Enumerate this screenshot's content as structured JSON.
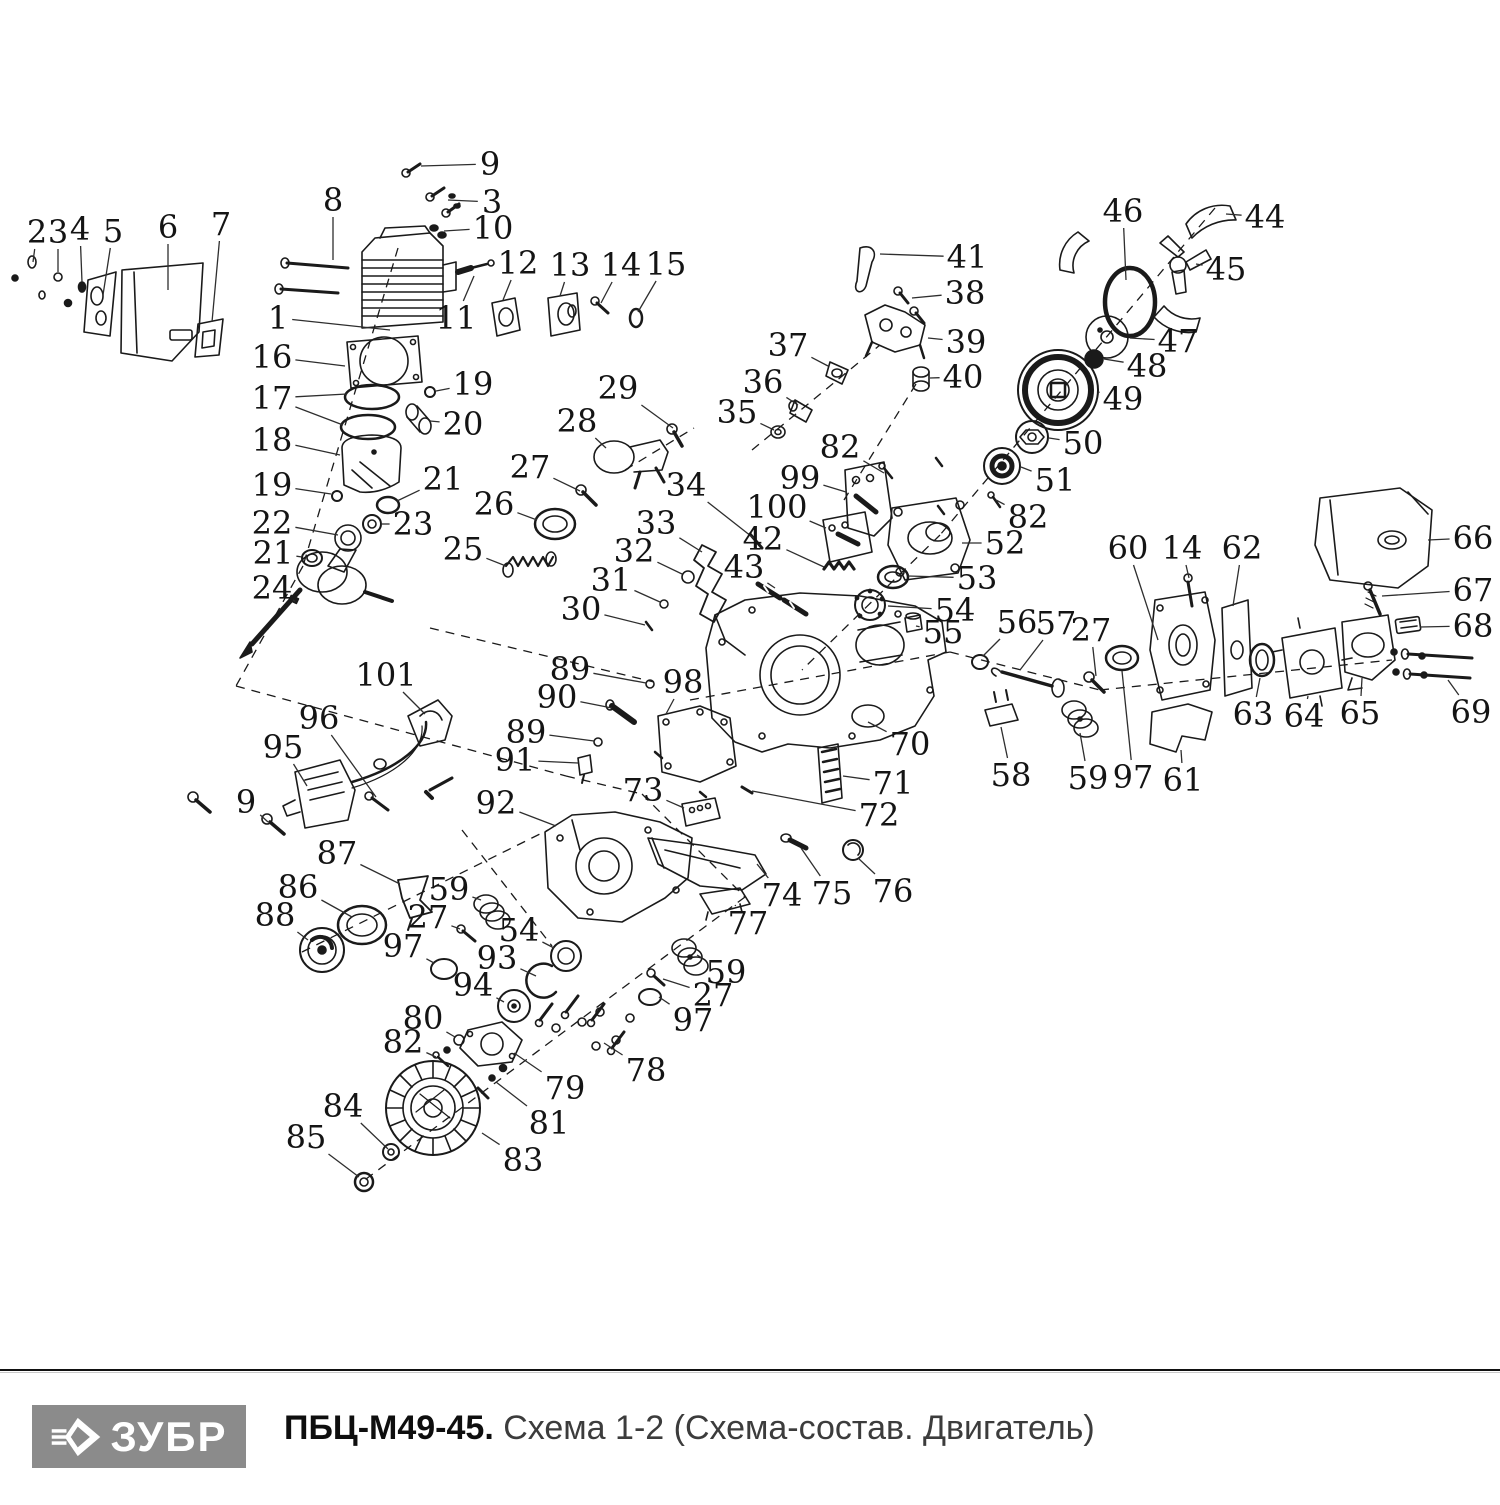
{
  "doc": {
    "type": "exploded-parts-diagram",
    "brand": "ЗУБР",
    "model": "ПБЦ-М49-45.",
    "subtitle": "Схема 1-2 (Схема-состав. Двигатель)",
    "logo_bg": "#8b8b8b",
    "line_color": "#1a1a1a",
    "label_color": "#141414"
  },
  "labels": [
    {
      "n": "2",
      "x": 37,
      "y": 232,
      "tx": 33,
      "ty": 262
    },
    {
      "n": "3",
      "x": 58,
      "y": 232,
      "tx": 58,
      "ty": 272
    },
    {
      "n": "4",
      "x": 80,
      "y": 229,
      "tx": 82,
      "ty": 282
    },
    {
      "n": "5",
      "x": 113,
      "y": 231,
      "tx": 103,
      "ty": 295
    },
    {
      "n": "6",
      "x": 168,
      "y": 227,
      "tx": 168,
      "ty": 290
    },
    {
      "n": "7",
      "x": 221,
      "y": 224,
      "tx": 212,
      "ty": 322
    },
    {
      "n": "8",
      "x": 333,
      "y": 200,
      "tx": 333,
      "ty": 260
    },
    {
      "n": "9",
      "x": 490,
      "y": 164,
      "tx": 421,
      "ty": 166
    },
    {
      "n": "3",
      "x": 492,
      "y": 202,
      "tx": 448,
      "ty": 200
    },
    {
      "n": "10",
      "x": 493,
      "y": 228,
      "tx": 444,
      "ty": 231
    },
    {
      "n": "1",
      "x": 278,
      "y": 318,
      "tx": 390,
      "ty": 330
    },
    {
      "n": "11",
      "x": 456,
      "y": 318,
      "tx": 474,
      "ty": 276
    },
    {
      "n": "12",
      "x": 518,
      "y": 263,
      "tx": 503,
      "ty": 300
    },
    {
      "n": "13",
      "x": 570,
      "y": 265,
      "tx": 560,
      "ty": 296
    },
    {
      "n": "14",
      "x": 621,
      "y": 265,
      "tx": 601,
      "ty": 303
    },
    {
      "n": "15",
      "x": 666,
      "y": 264,
      "tx": 638,
      "ty": 312
    },
    {
      "n": "16",
      "x": 272,
      "y": 357,
      "tx": 345,
      "ty": 366
    },
    {
      "n": "17",
      "x": 272,
      "y": 398,
      "tx": 347,
      "ty": 394,
      "tx2": 343,
      "ty2": 425
    },
    {
      "n": "18",
      "x": 272,
      "y": 440,
      "tx": 340,
      "ty": 455
    },
    {
      "n": "19",
      "x": 473,
      "y": 384,
      "tx": 436,
      "ty": 391
    },
    {
      "n": "20",
      "x": 463,
      "y": 424,
      "tx": 430,
      "ty": 421
    },
    {
      "n": "19",
      "x": 272,
      "y": 485,
      "tx": 331,
      "ty": 494
    },
    {
      "n": "21",
      "x": 443,
      "y": 479,
      "tx": 397,
      "ty": 501
    },
    {
      "n": "22",
      "x": 272,
      "y": 523,
      "tx": 338,
      "ty": 535
    },
    {
      "n": "23",
      "x": 413,
      "y": 524,
      "tx": 381,
      "ty": 524
    },
    {
      "n": "21",
      "x": 273,
      "y": 553,
      "tx": 302,
      "ty": 557
    },
    {
      "n": "24",
      "x": 272,
      "y": 588,
      "tx": 293,
      "ty": 600
    },
    {
      "n": "25",
      "x": 463,
      "y": 549,
      "tx": 506,
      "ty": 566
    },
    {
      "n": "26",
      "x": 494,
      "y": 504,
      "tx": 537,
      "ty": 520
    },
    {
      "n": "27",
      "x": 530,
      "y": 467,
      "tx": 580,
      "ty": 491
    },
    {
      "n": "28",
      "x": 577,
      "y": 421,
      "tx": 606,
      "ty": 448
    },
    {
      "n": "29",
      "x": 618,
      "y": 388,
      "tx": 673,
      "ty": 428
    },
    {
      "n": "30",
      "x": 581,
      "y": 609,
      "tx": 645,
      "ty": 625
    },
    {
      "n": "31",
      "x": 611,
      "y": 580,
      "tx": 660,
      "ty": 602
    },
    {
      "n": "32",
      "x": 634,
      "y": 551,
      "tx": 682,
      "ty": 574
    },
    {
      "n": "33",
      "x": 656,
      "y": 523,
      "tx": 702,
      "ty": 552
    },
    {
      "n": "34",
      "x": 686,
      "y": 485,
      "tx": 756,
      "ty": 540
    },
    {
      "n": "35",
      "x": 737,
      "y": 412,
      "tx": 774,
      "ty": 430
    },
    {
      "n": "36",
      "x": 763,
      "y": 382,
      "tx": 798,
      "ty": 405
    },
    {
      "n": "37",
      "x": 788,
      "y": 345,
      "tx": 828,
      "ty": 366
    },
    {
      "n": "38",
      "x": 965,
      "y": 293,
      "tx": 912,
      "ty": 298
    },
    {
      "n": "39",
      "x": 966,
      "y": 342,
      "tx": 928,
      "ty": 338
    },
    {
      "n": "40",
      "x": 963,
      "y": 377,
      "tx": 930,
      "ty": 378
    },
    {
      "n": "41",
      "x": 967,
      "y": 257,
      "tx": 880,
      "ty": 254
    },
    {
      "n": "42",
      "x": 763,
      "y": 539,
      "tx": 824,
      "ty": 567
    },
    {
      "n": "43",
      "x": 744,
      "y": 567,
      "tx": 775,
      "ty": 588
    },
    {
      "n": "44",
      "x": 1265,
      "y": 217,
      "tx": 1226,
      "ty": 214
    },
    {
      "n": "45",
      "x": 1226,
      "y": 269,
      "tx": 1196,
      "ty": 264
    },
    {
      "n": "46",
      "x": 1123,
      "y": 211,
      "tx": 1126,
      "ty": 280
    },
    {
      "n": "47",
      "x": 1178,
      "y": 341,
      "tx": 1130,
      "ty": 338
    },
    {
      "n": "48",
      "x": 1147,
      "y": 366,
      "tx": 1104,
      "ty": 359
    },
    {
      "n": "49",
      "x": 1123,
      "y": 399,
      "tx": 1098,
      "ty": 392
    },
    {
      "n": "50",
      "x": 1083,
      "y": 443,
      "tx": 1049,
      "ty": 438
    },
    {
      "n": "51",
      "x": 1055,
      "y": 480,
      "tx": 1021,
      "ty": 467
    },
    {
      "n": "82",
      "x": 840,
      "y": 447,
      "tx": 884,
      "ty": 473
    },
    {
      "n": "82",
      "x": 1028,
      "y": 517,
      "tx": 996,
      "ty": 500
    },
    {
      "n": "99",
      "x": 800,
      "y": 478,
      "tx": 846,
      "ty": 492
    },
    {
      "n": "100",
      "x": 777,
      "y": 507,
      "tx": 826,
      "ty": 528
    },
    {
      "n": "52",
      "x": 1005,
      "y": 543,
      "tx": 962,
      "ty": 543
    },
    {
      "n": "53",
      "x": 977,
      "y": 578,
      "tx": 908,
      "ty": 576
    },
    {
      "n": "54",
      "x": 955,
      "y": 610,
      "tx": 888,
      "ty": 606
    },
    {
      "n": "55",
      "x": 943,
      "y": 632,
      "tx": 916,
      "ty": 626
    },
    {
      "n": "56",
      "x": 1017,
      "y": 622,
      "tx": 983,
      "ty": 656
    },
    {
      "n": "57",
      "x": 1056,
      "y": 623,
      "tx": 1020,
      "ty": 670
    },
    {
      "n": "27",
      "x": 1091,
      "y": 630,
      "tx": 1096,
      "ty": 676
    },
    {
      "n": "58",
      "x": 1011,
      "y": 775,
      "tx": 1001,
      "ty": 727
    },
    {
      "n": "59",
      "x": 1088,
      "y": 778,
      "tx": 1080,
      "ty": 733
    },
    {
      "n": "97",
      "x": 1133,
      "y": 777,
      "tx": 1122,
      "ty": 671
    },
    {
      "n": "61",
      "x": 1183,
      "y": 780,
      "tx": 1181,
      "ty": 750
    },
    {
      "n": "60",
      "x": 1128,
      "y": 548,
      "tx": 1158,
      "ty": 640
    },
    {
      "n": "14",
      "x": 1182,
      "y": 548,
      "tx": 1189,
      "ty": 578
    },
    {
      "n": "62",
      "x": 1242,
      "y": 548,
      "tx": 1233,
      "ty": 606
    },
    {
      "n": "63",
      "x": 1253,
      "y": 714,
      "tx": 1260,
      "ty": 678
    },
    {
      "n": "64",
      "x": 1304,
      "y": 716,
      "tx": 1308,
      "ty": 696
    },
    {
      "n": "65",
      "x": 1360,
      "y": 713,
      "tx": 1362,
      "ty": 678
    },
    {
      "n": "66",
      "x": 1473,
      "y": 538,
      "tx": 1428,
      "ty": 540
    },
    {
      "n": "67",
      "x": 1473,
      "y": 590,
      "tx": 1382,
      "ty": 596
    },
    {
      "n": "68",
      "x": 1473,
      "y": 626,
      "tx": 1420,
      "ty": 627
    },
    {
      "n": "69",
      "x": 1471,
      "y": 712,
      "tx": 1448,
      "ty": 680
    },
    {
      "n": "70",
      "x": 910,
      "y": 744,
      "tx": 868,
      "ty": 722
    },
    {
      "n": "71",
      "x": 893,
      "y": 783,
      "tx": 843,
      "ty": 776
    },
    {
      "n": "72",
      "x": 879,
      "y": 815,
      "tx": 752,
      "ty": 791
    },
    {
      "n": "73",
      "x": 643,
      "y": 790,
      "tx": 684,
      "ty": 808
    },
    {
      "n": "74",
      "x": 782,
      "y": 895,
      "tx": 757,
      "ty": 864
    },
    {
      "n": "75",
      "x": 832,
      "y": 893,
      "tx": 801,
      "ty": 848
    },
    {
      "n": "76",
      "x": 893,
      "y": 891,
      "tx": 858,
      "ty": 858
    },
    {
      "n": "77",
      "x": 748,
      "y": 923,
      "tx": 735,
      "ty": 905
    },
    {
      "n": "59",
      "x": 726,
      "y": 972,
      "tx": 697,
      "ty": 955
    },
    {
      "n": "27",
      "x": 713,
      "y": 995,
      "tx": 663,
      "ty": 979
    },
    {
      "n": "97",
      "x": 693,
      "y": 1020,
      "tx": 659,
      "ty": 997
    },
    {
      "n": "89",
      "x": 570,
      "y": 669,
      "tx": 646,
      "ty": 683
    },
    {
      "n": "90",
      "x": 557,
      "y": 697,
      "tx": 612,
      "ty": 708
    },
    {
      "n": "89",
      "x": 526,
      "y": 732,
      "tx": 594,
      "ty": 741
    },
    {
      "n": "91",
      "x": 515,
      "y": 760,
      "tx": 578,
      "ty": 763
    },
    {
      "n": "92",
      "x": 496,
      "y": 803,
      "tx": 556,
      "ty": 826
    },
    {
      "n": "98",
      "x": 683,
      "y": 682,
      "tx": 666,
      "ty": 714
    },
    {
      "n": "101",
      "x": 386,
      "y": 675,
      "tx": 425,
      "ty": 714
    },
    {
      "n": "96",
      "x": 319,
      "y": 718,
      "tx": 376,
      "ty": 797
    },
    {
      "n": "95",
      "x": 283,
      "y": 747,
      "tx": 307,
      "ty": 786
    },
    {
      "n": "9",
      "x": 246,
      "y": 802,
      "tx": 268,
      "ty": 822
    },
    {
      "n": "87",
      "x": 337,
      "y": 853,
      "tx": 400,
      "ty": 884
    },
    {
      "n": "86",
      "x": 298,
      "y": 887,
      "tx": 352,
      "ty": 917
    },
    {
      "n": "88",
      "x": 275,
      "y": 915,
      "tx": 308,
      "ty": 940
    },
    {
      "n": "59",
      "x": 449,
      "y": 889,
      "tx": 481,
      "ty": 900
    },
    {
      "n": "27",
      "x": 428,
      "y": 917,
      "tx": 460,
      "ty": 929
    },
    {
      "n": "97",
      "x": 403,
      "y": 946,
      "tx": 434,
      "ty": 963
    },
    {
      "n": "54",
      "x": 519,
      "y": 930,
      "tx": 554,
      "ty": 948
    },
    {
      "n": "93",
      "x": 497,
      "y": 958,
      "tx": 536,
      "ty": 976
    },
    {
      "n": "94",
      "x": 473,
      "y": 985,
      "tx": 504,
      "ty": 1002
    },
    {
      "n": "80",
      "x": 423,
      "y": 1018,
      "tx": 455,
      "ty": 1037
    },
    {
      "n": "82",
      "x": 403,
      "y": 1042,
      "tx": 436,
      "ty": 1057
    },
    {
      "n": "79",
      "x": 565,
      "y": 1088,
      "tx": 514,
      "ty": 1053
    },
    {
      "n": "81",
      "x": 549,
      "y": 1123,
      "tx": 496,
      "ty": 1082
    },
    {
      "n": "78",
      "x": 646,
      "y": 1070,
      "tx": 604,
      "ty": 1043
    },
    {
      "n": "84",
      "x": 343,
      "y": 1106,
      "tx": 388,
      "ty": 1149
    },
    {
      "n": "85",
      "x": 306,
      "y": 1137,
      "tx": 359,
      "ty": 1177
    },
    {
      "n": "83",
      "x": 523,
      "y": 1160,
      "tx": 482,
      "ty": 1133
    }
  ],
  "axes": [
    [
      398,
      248,
      303,
      566
    ],
    [
      303,
      566,
      236,
      686
    ],
    [
      236,
      686,
      566,
      776
    ],
    [
      566,
      776,
      642,
      794
    ],
    [
      642,
      794,
      745,
      897
    ],
    [
      745,
      897,
      362,
      1182
    ],
    [
      752,
      450,
      880,
      345
    ],
    [
      916,
      384,
      844,
      500
    ],
    [
      1215,
      208,
      940,
      535
    ],
    [
      940,
      535,
      802,
      670
    ],
    [
      690,
      700,
      950,
      652
    ],
    [
      950,
      652,
      1100,
      690
    ],
    [
      1100,
      690,
      1392,
      660
    ],
    [
      302,
      952,
      548,
      830
    ],
    [
      430,
      628,
      654,
      682
    ],
    [
      625,
      470,
      694,
      428
    ],
    [
      462,
      830,
      552,
      946
    ]
  ]
}
